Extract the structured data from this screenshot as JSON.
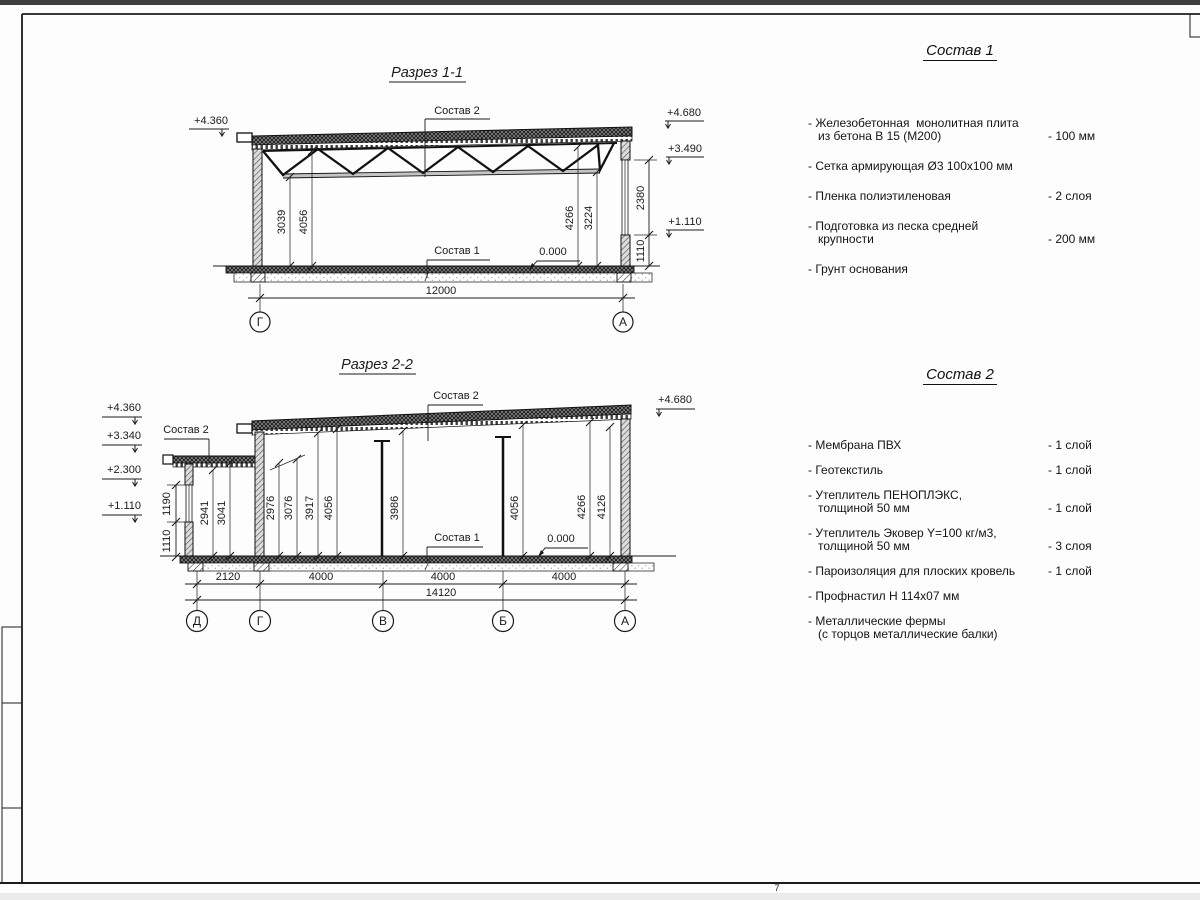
{
  "frame": {
    "sheet_mark": "7"
  },
  "section1": {
    "title": "Разрез 1-1",
    "labels": {
      "sostav2": "Состав 2",
      "sostav1": "Состав 1",
      "zero": "0.000",
      "elev_left": "+4.360",
      "elev_r1": "+4.680",
      "elev_r2": "+3.490",
      "elev_r3": "+1.110"
    },
    "dims": {
      "v1": "3039",
      "v2": "4056",
      "v3": "4266",
      "v4": "3224",
      "r1": "2380",
      "r2": "1110",
      "total": "12000"
    },
    "axes": {
      "left": "Г",
      "right": "А"
    }
  },
  "section2": {
    "title": "Разрез 2-2",
    "labels": {
      "sostav2_low": "Состав 2",
      "sostav2_high": "Состав 2",
      "sostav1": "Состав 1",
      "zero": "0.000",
      "elev_l1": "+4.360",
      "elev_l2": "+3.340",
      "elev_l3": "+2.300",
      "elev_l4": "+1.110",
      "elev_r": "+4.680"
    },
    "dims": {
      "out1": "1190",
      "out2": "1110",
      "v": [
        "2941",
        "3041",
        "2976",
        "3076",
        "3917",
        "4056",
        "3986",
        "4056",
        "4266",
        "4126"
      ],
      "h": [
        "2120",
        "4000",
        "4000",
        "4000"
      ],
      "total": "14120"
    },
    "axes": [
      "Д",
      "Г",
      "В",
      "Б",
      "А"
    ]
  },
  "sostav1": {
    "title": "Состав 1",
    "items": [
      {
        "name": "- Железобетонная  монолитная плита\n   из бетона В 15 (М200)",
        "value": "- 100 мм"
      },
      {
        "name": "- Сетка армирующая Ø3 100х100 мм",
        "value": ""
      },
      {
        "name": "- Пленка полиэтиленовая",
        "value": "-  2 слоя"
      },
      {
        "name": "- Подготовка из песка средней\n   крупности",
        "value": "- 200 мм"
      },
      {
        "name": "- Грунт основания",
        "value": ""
      }
    ]
  },
  "sostav2": {
    "title": "Состав 2",
    "items": [
      {
        "name": "- Мембрана ПВХ",
        "value": "- 1 слой"
      },
      {
        "name": "- Геотекстиль",
        "value": "- 1 слой"
      },
      {
        "name": "- Утеплитель ПЕНОПЛЭКС,\n   толщиной 50 мм",
        "value": "- 1 слой"
      },
      {
        "name": "- Утеплитель Эковер Y=100 кг/м3,\n   толщиной 50 мм",
        "value": "- 3 слоя"
      },
      {
        "name": "- Пароизоляция для плоских кровель",
        "value": "- 1 слой"
      },
      {
        "name": "- Профнастил Н 114х07 мм",
        "value": ""
      },
      {
        "name": "- Металлические фермы\n   (с торцов металлические балки)",
        "value": ""
      }
    ]
  }
}
